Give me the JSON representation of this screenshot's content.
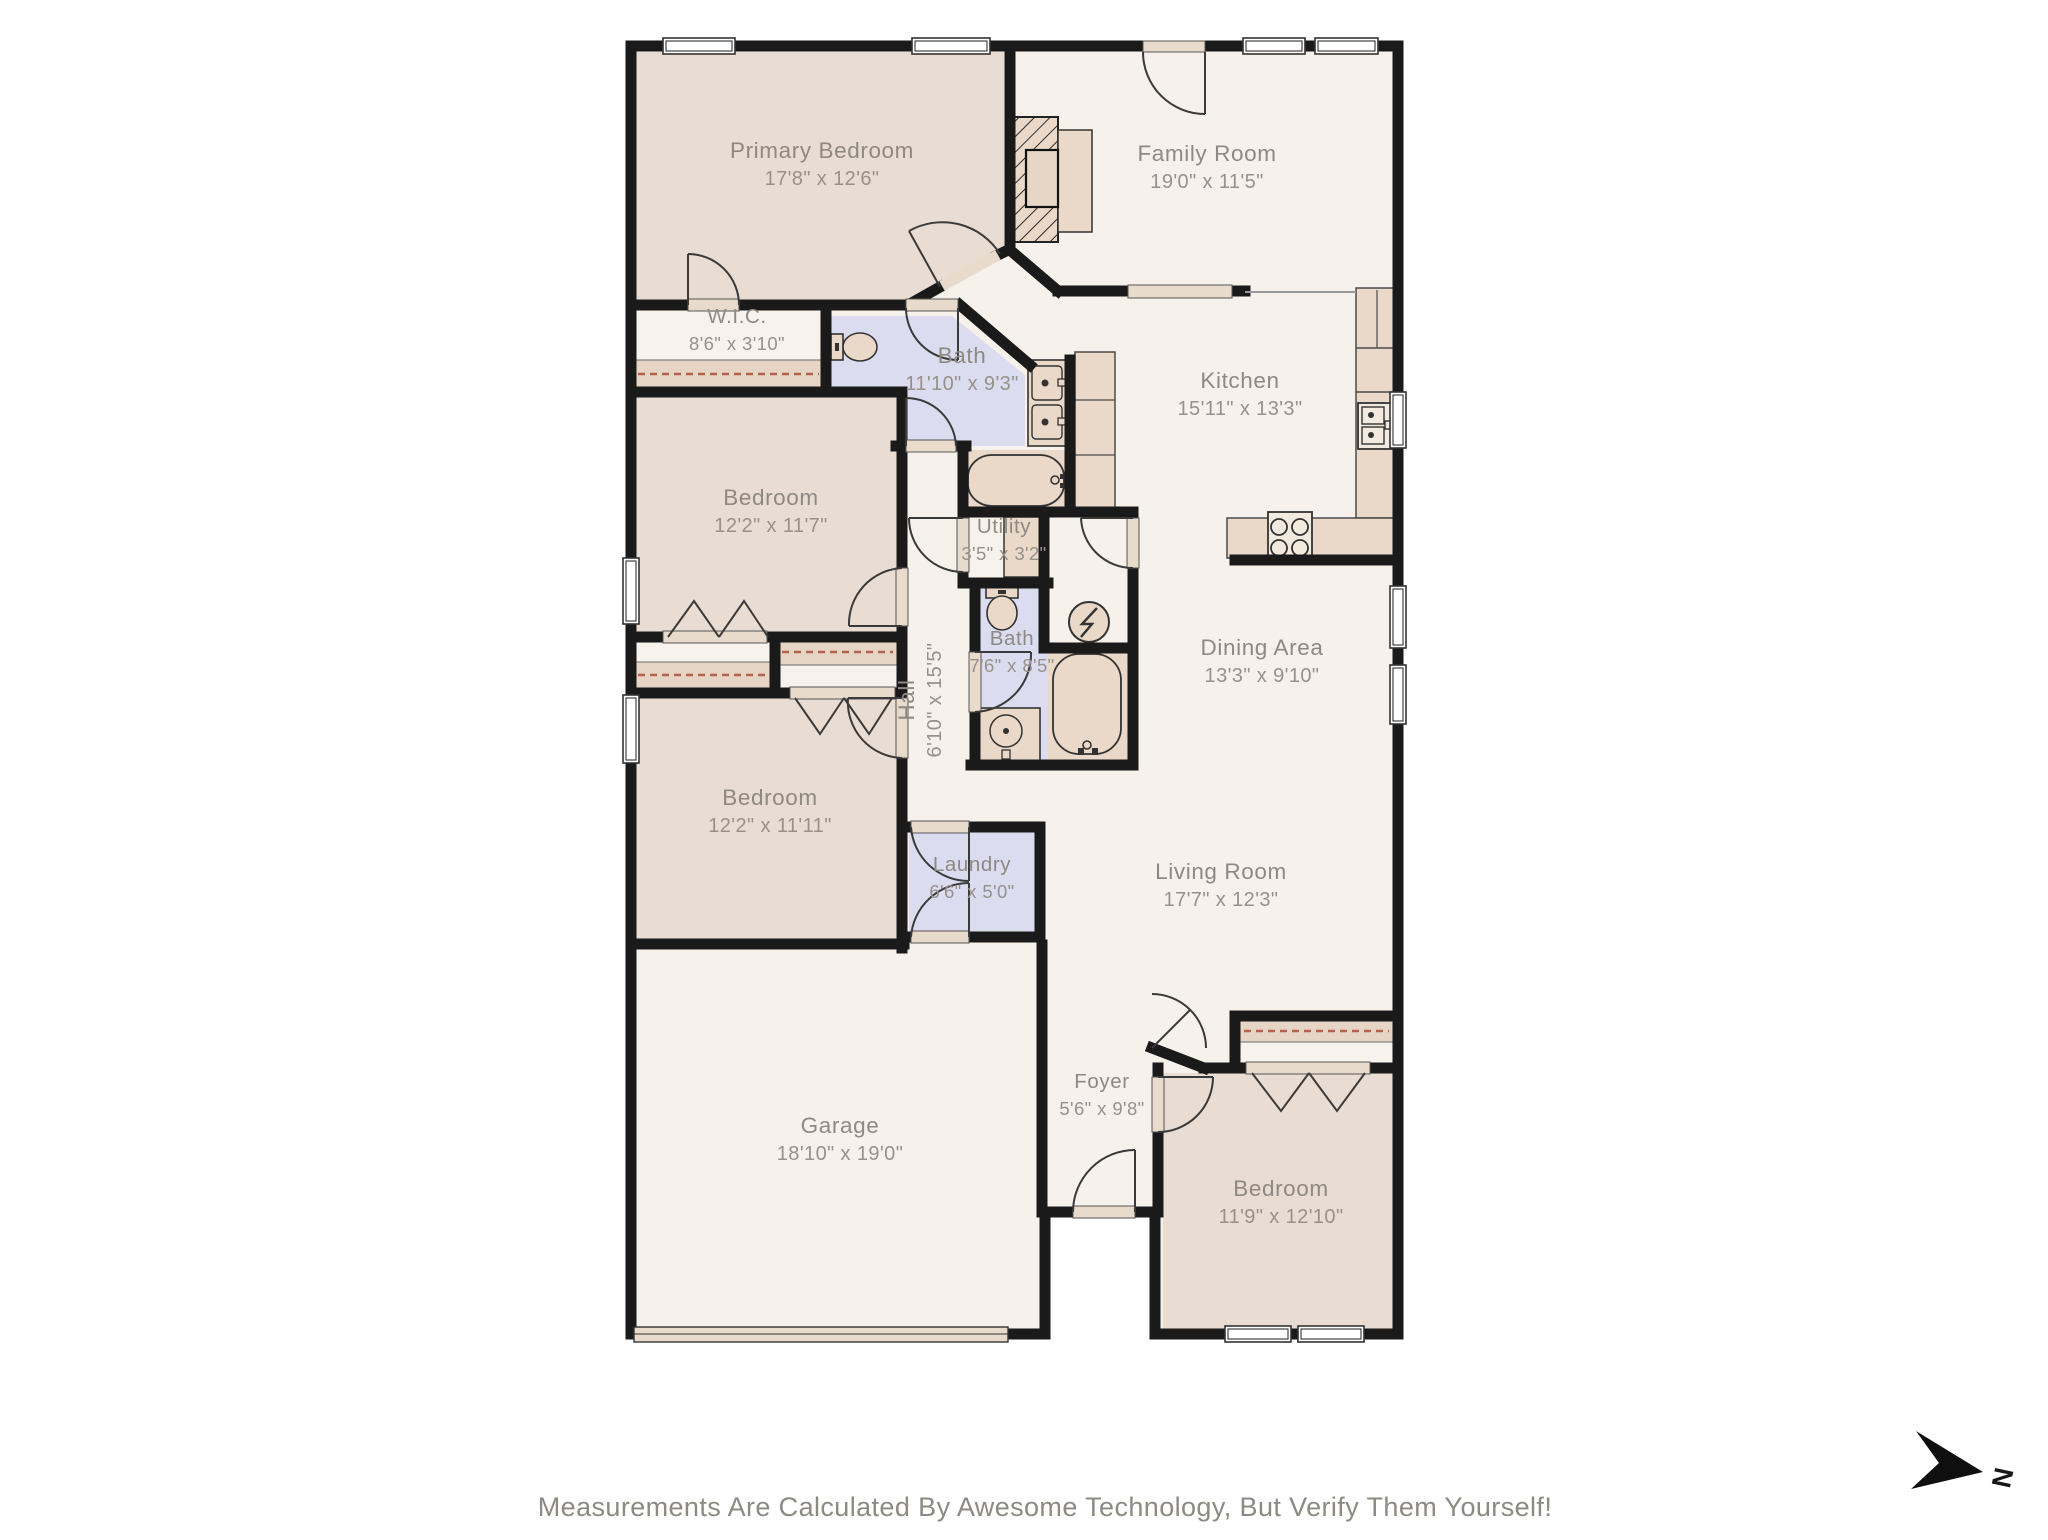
{
  "page": {
    "disclaimer": "Measurements Are Calculated By Awesome Technology, But Verify Them Yourself!"
  },
  "compass": {
    "label": "N"
  },
  "palette": {
    "floor": "#f6f1ea",
    "bedroom_floor": "#e9dcd2",
    "bath_floor": "#dcdcf0",
    "closet_floor": "#f7f3ec",
    "wall": "#1a1a1a",
    "fixture_fill": "#ead9c9",
    "fixture_light": "#f2e9df",
    "sill": "#e9dbcb",
    "rod_dash": "#b4624e",
    "label_name": "#8e8982",
    "label_dims": "#97918a",
    "arc_stroke": "#3a3a3a"
  },
  "rooms": [
    {
      "id": "primary-bedroom",
      "name": "Primary Bedroom",
      "dims": "17'8\" x 12'6\"",
      "x": 822,
      "y": 165
    },
    {
      "id": "family-room",
      "name": "Family Room",
      "dims": "19'0\" x 11'5\"",
      "x": 1207,
      "y": 168
    },
    {
      "id": "wic",
      "name": "W.I.C.",
      "dims": "8'6\" x 3'10\"",
      "x": 737,
      "y": 330,
      "small": true
    },
    {
      "id": "bath-primary",
      "name": "Bath",
      "dims": "11'10\" x 9'3\"",
      "x": 962,
      "y": 370
    },
    {
      "id": "kitchen",
      "name": "Kitchen",
      "dims": "15'11\" x 13'3\"",
      "x": 1240,
      "y": 395
    },
    {
      "id": "bedroom-2",
      "name": "Bedroom",
      "dims": "12'2\" x 11'7\"",
      "x": 771,
      "y": 512
    },
    {
      "id": "utility",
      "name": "Utility",
      "dims": "3'5\" x 3'2\"",
      "x": 1004,
      "y": 540,
      "small": true
    },
    {
      "id": "bath-2",
      "name": "Bath",
      "dims": "7'6\" x 8'5\"",
      "x": 1012,
      "y": 652,
      "small": true
    },
    {
      "id": "hall",
      "name": "Hall",
      "dims": "6'10\" x 15'5\"",
      "x": 921,
      "y": 700,
      "rotate": -90
    },
    {
      "id": "dining-area",
      "name": "Dining Area",
      "dims": "13'3\" x 9'10\"",
      "x": 1262,
      "y": 662
    },
    {
      "id": "bedroom-3",
      "name": "Bedroom",
      "dims": "12'2\" x 11'11\"",
      "x": 770,
      "y": 812
    },
    {
      "id": "laundry",
      "name": "Laundry",
      "dims": "6'6\" x 5'0\"",
      "x": 972,
      "y": 878,
      "small": true
    },
    {
      "id": "living-room",
      "name": "Living Room",
      "dims": "17'7\" x 12'3\"",
      "x": 1221,
      "y": 886
    },
    {
      "id": "garage",
      "name": "Garage",
      "dims": "18'10\" x 19'0\"",
      "x": 840,
      "y": 1140
    },
    {
      "id": "foyer",
      "name": "Foyer",
      "dims": "5'6\" x 9'8\"",
      "x": 1102,
      "y": 1095,
      "small": true
    },
    {
      "id": "bedroom-4",
      "name": "Bedroom",
      "dims": "11'9\" x 12'10\"",
      "x": 1281,
      "y": 1203
    }
  ],
  "fixture_icons": [
    "fireplace-icon",
    "stove-icon",
    "kitchen-sink-icon",
    "refrigerator-icon",
    "pantry-cabinet-icon",
    "double-vanity-icon",
    "bathtub-icon",
    "toilet-icon",
    "water-heater-icon",
    "electrical-panel-icon",
    "vanity-sink-icon",
    "closet-rod-icon",
    "garage-door-icon",
    "window-icon",
    "door-arc-icon",
    "north-arrow-icon"
  ]
}
